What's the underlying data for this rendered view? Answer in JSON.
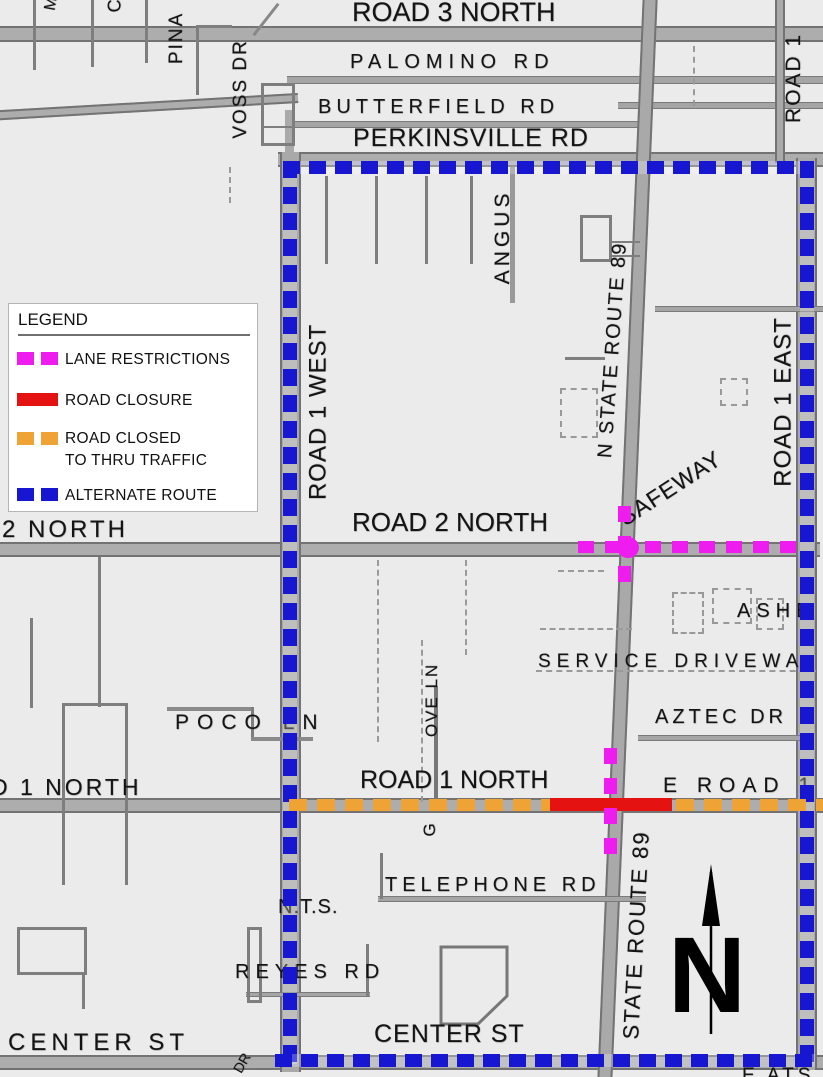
{
  "map": {
    "top_roads": {
      "road_3_north": "ROAD 3 NORTH",
      "palomino_rd": "PALOMINO RD",
      "butterfield_rd": "BUTTERFIELD RD",
      "perkinsville_rd": "PERKINSVILLE RD",
      "pina": "PINA",
      "voss_dr": "VOSS DR",
      "road_1": "ROAD 1",
      "cut_letter_c": "C",
      "cut_letter_m": "M"
    },
    "mid": {
      "angus": "ANGUS",
      "road_1_west": "ROAD 1 WEST",
      "road_1_east": "ROAD 1 EAST",
      "n_state_route_89": "N STATE ROUTE 89",
      "safeway": "SAFEWAY",
      "road_2_north": "ROAD 2 NORTH",
      "road_2_north_left": "2 NORTH",
      "ashby": "ASHB",
      "service_driveway": "SERVICE DRIVEWA",
      "aztec_dr": "AZTEC DR",
      "poco_ln": "POCO LN"
    },
    "lower": {
      "road_1_north": "ROAD 1 NORTH",
      "road_1_north_left": "D 1 NORTH",
      "e_road_1": "E ROAD 1",
      "gove_ln_upper": "OVE LN",
      "gove_ln_lower": "G",
      "telephone_rd": "TELEPHONE RD",
      "nts": "N.T.S.",
      "reyes_rd": "REYES RD",
      "center_st_left": "CENTER ST",
      "center_st": "CENTER ST",
      "state_route_89": "STATE ROUTE 89",
      "dr_fragment": "DR",
      "bottom_edge_fragment": "E ATS"
    },
    "north_arrow": {
      "label": "N"
    }
  },
  "legend": {
    "title": "LEGEND",
    "items": [
      {
        "label": "LANE RESTRICTIONS",
        "color": "#EE1CEE",
        "style": "dashed"
      },
      {
        "label": "ROAD CLOSURE",
        "color": "#E51212",
        "style": "solid"
      },
      {
        "label": "ROAD CLOSED",
        "label_line2": "TO THRU TRAFFIC",
        "color": "#F0A335",
        "style": "dashed"
      },
      {
        "label": "ALTERNATE ROUTE",
        "color": "#1717D2",
        "style": "dashed"
      }
    ]
  },
  "colors": {
    "lane_restrictions": "#EE1CEE",
    "road_closure": "#E51212",
    "road_closed_to_thru_traffic": "#F0A335",
    "alternate_route": "#1717D2",
    "road_gray": "#ADADAD",
    "background": "#EBEBEB"
  }
}
